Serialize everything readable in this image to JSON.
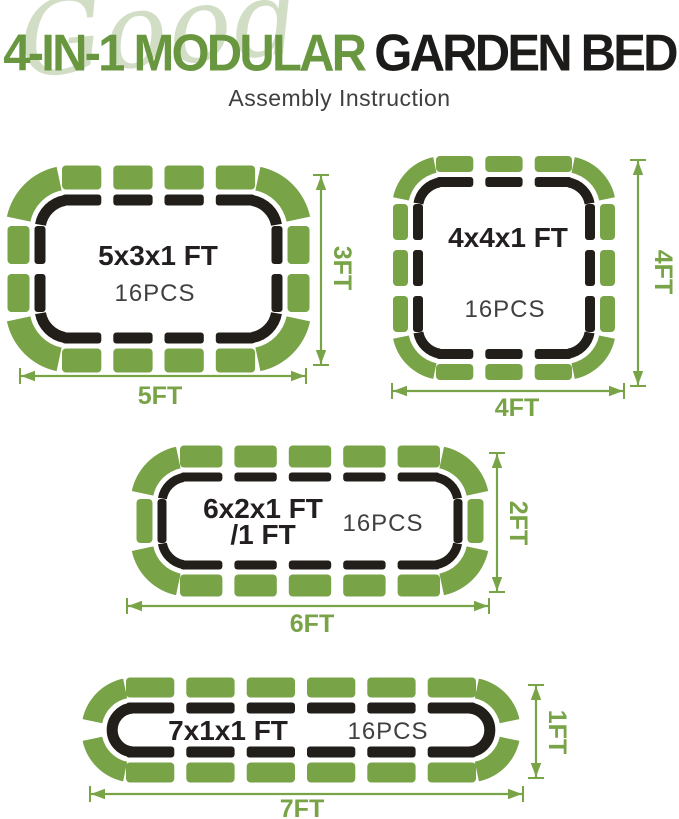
{
  "header": {
    "watermark": "Good",
    "title_green": "4-IN-1 MODULAR",
    "title_dark": "GARDEN BED",
    "subtitle": "Assembly Instruction"
  },
  "colors": {
    "panel_green": "#78a347",
    "title_green": "#689740",
    "title_dark": "#1c1b1a",
    "watermark_green": "#d2ddc5",
    "outline_black": "#221e19",
    "size_label_black": "#231f20",
    "pcs_gray": "#3f4041",
    "subtitle_gray": "#3f3f3f"
  },
  "beds": [
    {
      "name": "5x3 garden bed",
      "size_label": "5x3x1 FT",
      "size_label_line2": "",
      "pcs_label": "16PCS",
      "width_label": "5FT",
      "height_label": "3FT",
      "top_panel_count": 4,
      "bottom_panel_count": 4,
      "side_panel_count": 2,
      "corner_panel_count": 4,
      "total_pieces": 16
    },
    {
      "name": "4x4 garden bed",
      "size_label": "4x4x1 FT",
      "size_label_line2": "",
      "pcs_label": "16PCS",
      "width_label": "4FT",
      "height_label": "4FT",
      "top_panel_count": 3,
      "bottom_panel_count": 3,
      "side_panel_count": 3,
      "corner_panel_count": 4,
      "total_pieces": 16
    },
    {
      "name": "6x2 garden bed",
      "size_label": "6x2x1 FT",
      "size_label_line2": "/1 FT",
      "pcs_label": "16PCS",
      "width_label": "6FT",
      "height_label": "2FT",
      "top_panel_count": 5,
      "bottom_panel_count": 5,
      "side_panel_count": 1,
      "corner_panel_count": 4,
      "total_pieces": 16
    },
    {
      "name": "7x1 garden bed",
      "size_label": "7x1x1 FT",
      "size_label_line2": "",
      "pcs_label": "16PCS",
      "width_label": "7FT",
      "height_label": "1FT",
      "top_panel_count": 6,
      "bottom_panel_count": 6,
      "side_panel_count": 0,
      "corner_panel_count": 4,
      "total_pieces": 16
    }
  ]
}
